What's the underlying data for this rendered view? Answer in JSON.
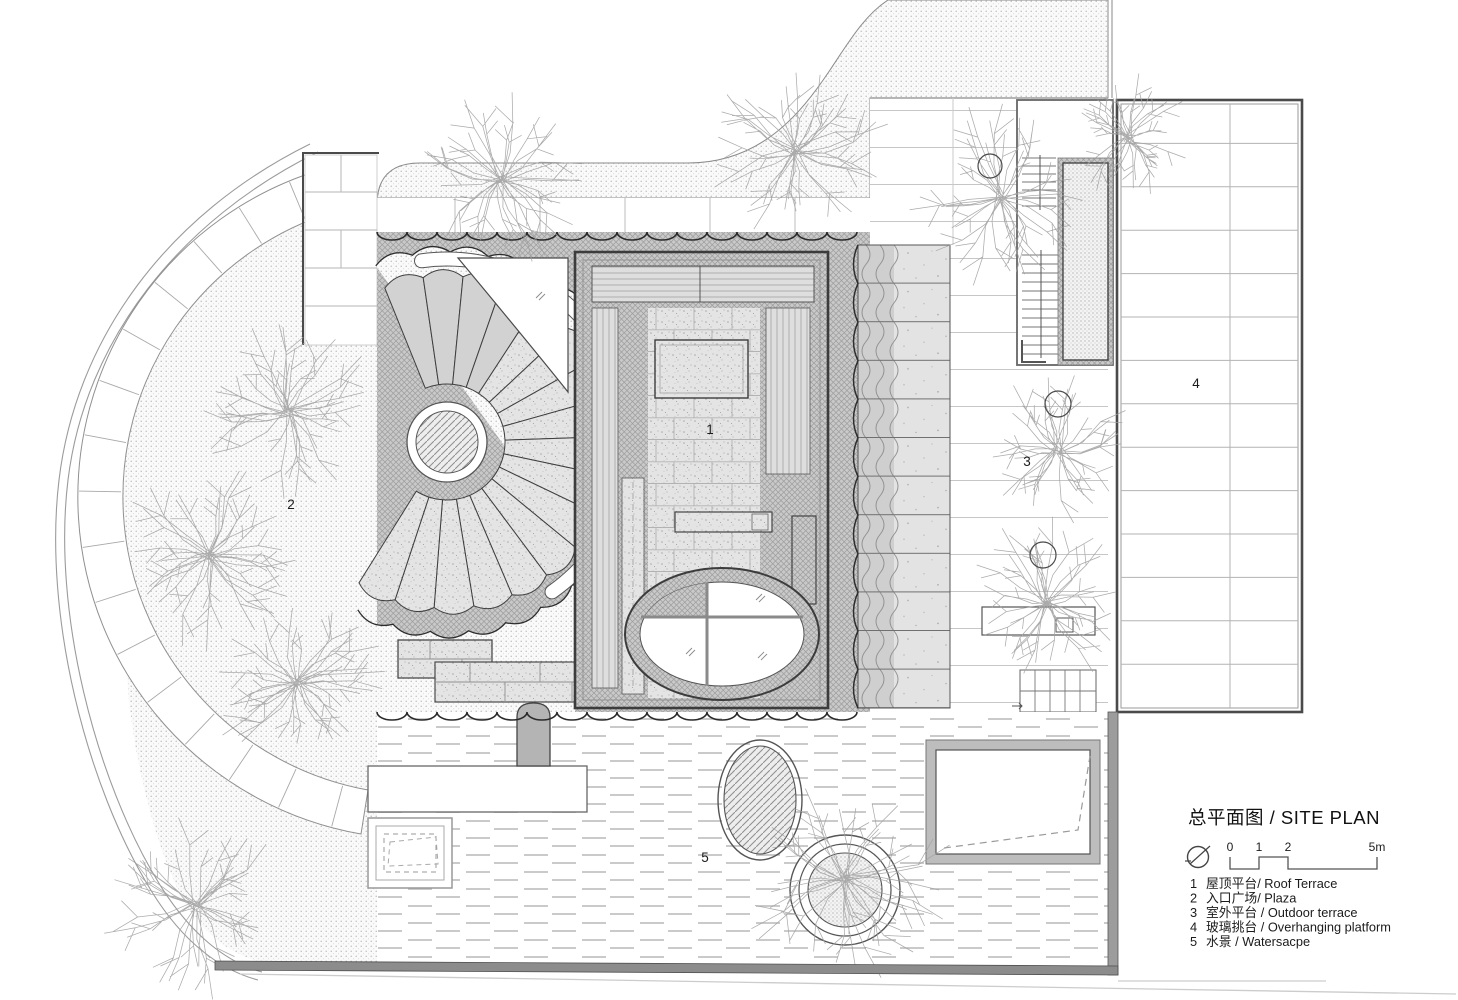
{
  "title": "总平面图 / SITE PLAN",
  "scale_bar": {
    "ticks": [
      "0",
      "1",
      "2",
      "5m"
    ]
  },
  "legend": {
    "items": [
      {
        "num": "1",
        "label": "屋顶平台/ Roof Terrace"
      },
      {
        "num": "2",
        "label": "入口广场/ Plaza"
      },
      {
        "num": "3",
        "label": "室外平台 / Outdoor terrace"
      },
      {
        "num": "4",
        "label": "玻璃挑台 / Overhanging platform"
      },
      {
        "num": "5",
        "label": "水景 / Watersacpe"
      }
    ]
  },
  "plan_labels": [
    {
      "num": "1",
      "name": "roof-terrace"
    },
    {
      "num": "2",
      "name": "plaza"
    },
    {
      "num": "3",
      "name": "outdoor-terrace"
    },
    {
      "num": "4",
      "name": "overhanging-platform"
    },
    {
      "num": "5",
      "name": "waterscape"
    }
  ],
  "colors": {
    "ink": "#1b1b1b",
    "line_dark": "#3c3c3c",
    "line_mid": "#8a8a8a",
    "hatch_gray": "#c9c9c9",
    "water_dash": "#b8b8b8",
    "bar_gray": "#8c8c8c"
  }
}
